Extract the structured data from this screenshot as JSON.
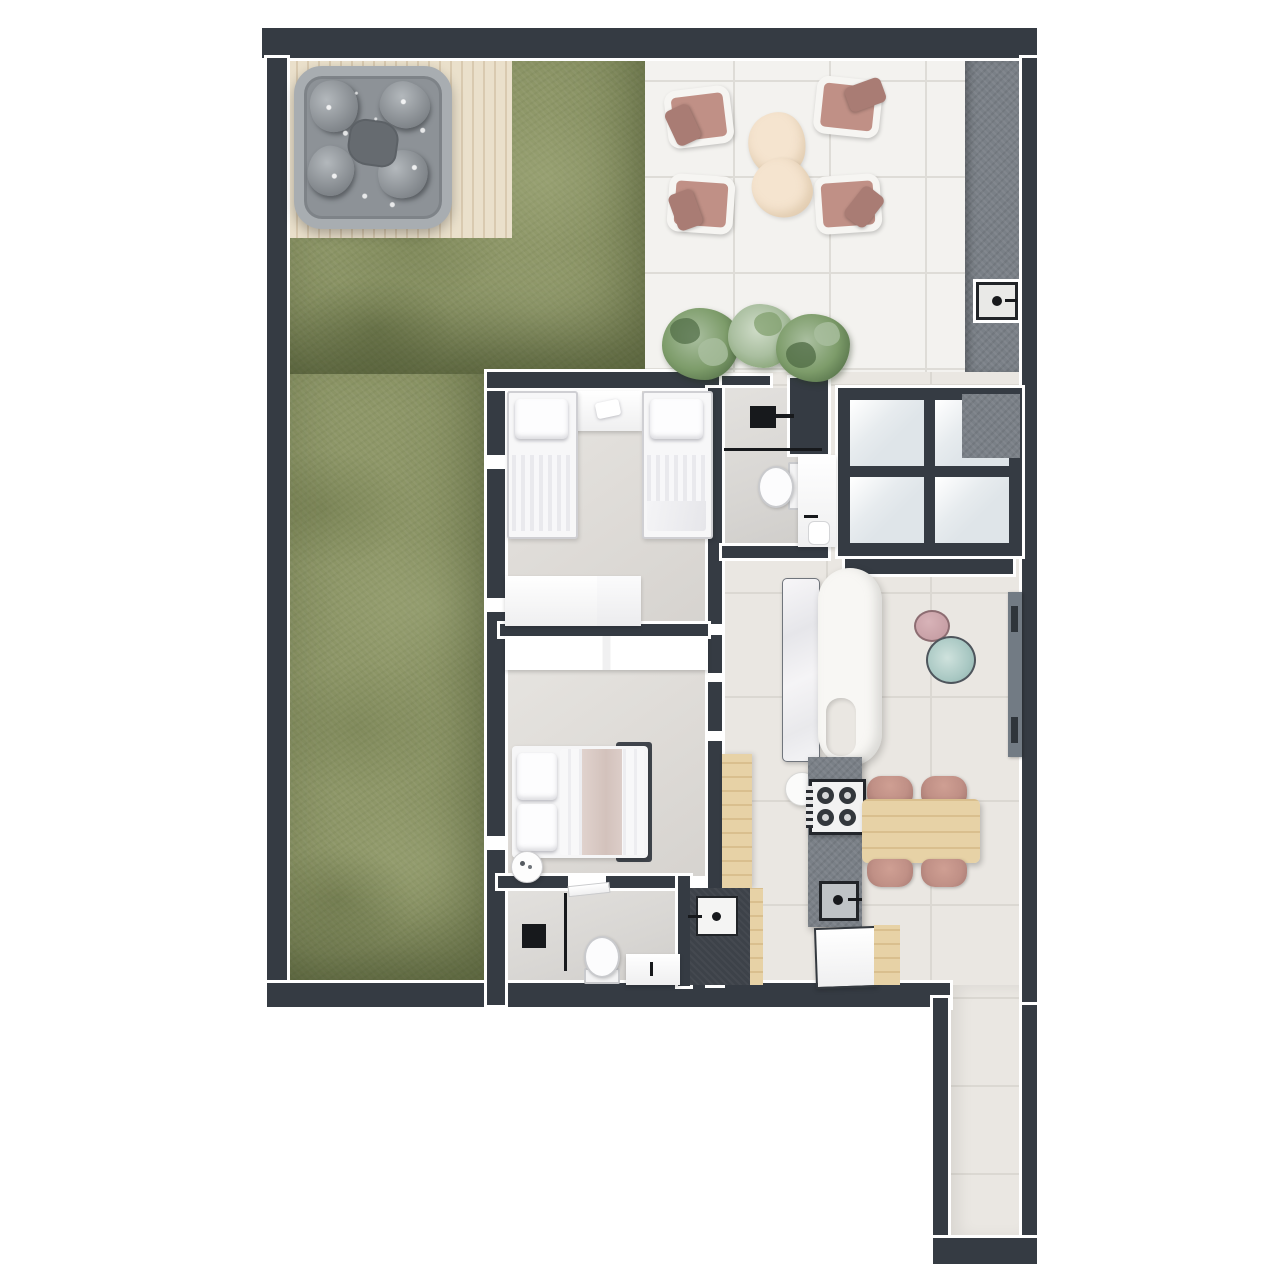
{
  "palette": {
    "wall": "#353b43",
    "seam": "#ffffff",
    "grass": "#8e9768",
    "grass_dark": "#5f6c44",
    "grass_light": "#a9b284",
    "deck": "#eae0cb",
    "deck_line": "#d9cab0",
    "tub_rim": "#a8adb1",
    "tub_basin": "#8d9297",
    "tub_seat": "#b3b8bc",
    "tub_shadow": "#666b70",
    "patio_tile": "#f3f2ef",
    "patio_line": "#dedcd7",
    "counter_gray": "#7a8087",
    "glass_pane": "#dfe5e9",
    "floor_warm": "#eae7e2",
    "floor_line": "#dbd8d2",
    "floor_bedroom": "#dedbd7",
    "floor_bath": "#d8d6d3",
    "dark_panel": "#3d4249",
    "wood": "#e7d2a6",
    "wood_deep": "#d9bf8e",
    "white": "#ffffff",
    "black_fixture": "#17191c",
    "chair_pink": "#c09086",
    "chair_pink_deep": "#a97c74",
    "cushion_cream": "#f5e4cf",
    "plant_dark": "#4f6b44",
    "plant_mid": "#7d9c6a",
    "plant_light": "#aabfa0",
    "marble": "#f4f4f6",
    "sofa_white": "#f8f7f4",
    "table_pink": "#c8a0a6",
    "table_teal": "#a9c8c3",
    "tv_gray": "#727b84"
  },
  "rooms": [
    {
      "name": "garden",
      "features": [
        "grass-lawn",
        "wood-deck",
        "hot-tub"
      ]
    },
    {
      "name": "patio",
      "features": [
        "armchair",
        "armchair",
        "armchair",
        "armchair",
        "ottoman-table",
        "ottoman-table",
        "plant",
        "plant",
        "plant"
      ]
    },
    {
      "name": "outdoor-counter",
      "features": [
        "built-in-sink"
      ]
    },
    {
      "name": "twin-bedroom",
      "features": [
        "single-bed",
        "single-bed",
        "headboard-shelf",
        "dresser"
      ]
    },
    {
      "name": "bathroom-top",
      "features": [
        "shower-head",
        "shower-screen",
        "toilet",
        "washbasin"
      ]
    },
    {
      "name": "glass-partition",
      "features": [
        "four-pane-glass-wall",
        "counter-block"
      ]
    },
    {
      "name": "living-room",
      "features": [
        "curved-sofa",
        "marble-console",
        "side-table-pink",
        "side-table-teal",
        "tv-panel",
        "round-stool"
      ]
    },
    {
      "name": "kitchen-dining",
      "features": [
        "wood-counter",
        "island-counter",
        "cooktop-4-burners",
        "kitchen-sink",
        "refrigerator",
        "wood-cabinet",
        "dining-table",
        "dining-chair",
        "dining-chair",
        "dining-chair",
        "dining-chair"
      ]
    },
    {
      "name": "master-bedroom",
      "features": [
        "double-bed",
        "wardrobe",
        "round-side-table"
      ]
    },
    {
      "name": "bathroom-bottom",
      "features": [
        "shower-mat",
        "shower-screen",
        "toilet",
        "washbasin",
        "door-leaf"
      ]
    },
    {
      "name": "laundry",
      "features": [
        "utility-sink"
      ]
    },
    {
      "name": "hallway",
      "features": [
        "tiled-corridor"
      ]
    }
  ],
  "counts": {
    "patio_armchairs": 4,
    "dining_chairs": 4,
    "cooktop_burners": 4,
    "glass_panes": 4,
    "plants": 3,
    "beds": 3
  }
}
